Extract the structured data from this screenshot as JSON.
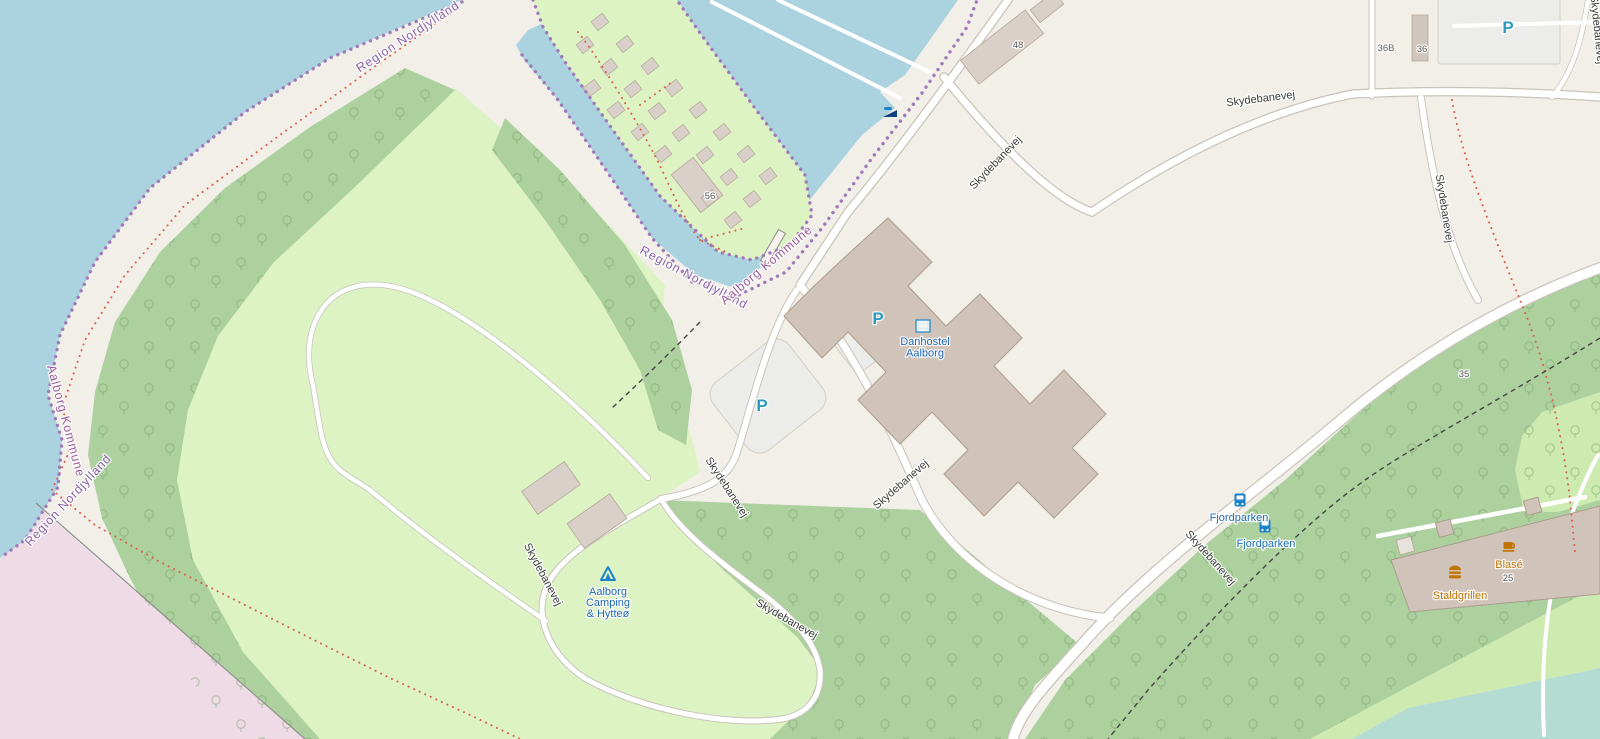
{
  "map": {
    "colors": {
      "land": "#f2efe9",
      "water": "#aad3df",
      "water_shallow": "#b5dcd2",
      "field": "#ddf3c4",
      "forest": "#add19e",
      "grass": "#cdebb0",
      "military_pink": "#eedbe6",
      "building": "#d9d0c9",
      "building_stroke": "#b3a796",
      "building_large": "#cfc3ba",
      "parking": "#ececea",
      "road_fill": "#ffffff",
      "road_casing": "#c9c3ba",
      "boundary": "#9f7bb8",
      "path_red": "#dd5f4a",
      "path_dashed": "#454545",
      "label_road": "#3d3d3d",
      "label_housenumber": "#5f5f5f",
      "label_boundary_region": "#8a63a8",
      "label_boundary_kommune": "#9d5b9d",
      "label_transport": "#2470b8",
      "label_tourism": "#2069b3",
      "label_amenity": "#c17404",
      "icon_blue": "#1d83c9",
      "icon_parking": "#2f9ac0",
      "icon_slipway": "#10427e"
    },
    "boundary_labels": [
      {
        "text": "Region Nordjylland",
        "x": 410,
        "y": 40,
        "rotate": -33,
        "kind": "region"
      },
      {
        "text": "Region Nordjylland",
        "x": 692,
        "y": 281,
        "rotate": 28,
        "kind": "region"
      },
      {
        "text": "Aalborg Kommune",
        "x": 769,
        "y": 268,
        "rotate": -40,
        "kind": "kommune"
      },
      {
        "text": "Aalborg Kommune",
        "x": 62,
        "y": 422,
        "rotate": 75,
        "kind": "kommune"
      },
      {
        "text": "Region Nordjylland",
        "x": 71,
        "y": 503,
        "rotate": -47,
        "kind": "region"
      }
    ],
    "road_labels": [
      {
        "text": "Skydebanevej",
        "x": 998,
        "y": 165,
        "rotate": -46
      },
      {
        "text": "Skydebanevej",
        "x": 1261,
        "y": 102,
        "rotate": -7
      },
      {
        "text": "Skydebanevej",
        "x": 1441,
        "y": 209,
        "rotate": 81
      },
      {
        "text": "Skydebanevej",
        "x": 1594,
        "y": 30,
        "rotate": 84
      },
      {
        "text": "Skydebanevej",
        "x": 903,
        "y": 487,
        "rotate": -41
      },
      {
        "text": "Skydebanevej",
        "x": 724,
        "y": 489,
        "rotate": 57
      },
      {
        "text": "Skydebanevej",
        "x": 540,
        "y": 576,
        "rotate": 62
      },
      {
        "text": "Skydebanevej",
        "x": 785,
        "y": 622,
        "rotate": 30
      },
      {
        "text": "Skydebanevej",
        "x": 1208,
        "y": 560,
        "rotate": 48
      }
    ],
    "house_numbers": [
      {
        "text": "56",
        "x": 710,
        "y": 199
      },
      {
        "text": "48",
        "x": 1018,
        "y": 48
      },
      {
        "text": "36B",
        "x": 1386,
        "y": 51
      },
      {
        "text": "36",
        "x": 1422,
        "y": 52
      },
      {
        "text": "35",
        "x": 1464,
        "y": 377
      },
      {
        "text": "25",
        "x": 1508,
        "y": 581
      }
    ],
    "pois": [
      {
        "name": "Danhostel Aalborg",
        "icon": "hostel-icon",
        "icon_x": 923,
        "icon_y": 326,
        "lines": [
          "Danhostel",
          "Aalborg"
        ],
        "label_x": 925,
        "label_y": 345,
        "line_height": 11.5,
        "color_key": "label_tourism"
      },
      {
        "name": "Aalborg Camping & Hytteø",
        "icon": "campsite-icon",
        "icon_x": 608,
        "icon_y": 574,
        "lines": [
          "Aalborg",
          "Camping",
          "& Hytteø"
        ],
        "label_x": 608,
        "label_y": 595,
        "line_height": 11,
        "color_key": "label_tourism"
      },
      {
        "name": "Fjordparken",
        "icon": "bus-icon",
        "icon_x": 1240,
        "icon_y": 500,
        "lines": [
          "Fjordparken"
        ],
        "label_x": 1239,
        "label_y": 521,
        "line_height": 11,
        "color_key": "label_transport"
      },
      {
        "name": "Fjordparken",
        "icon": "bus-icon",
        "icon_x": 1265,
        "icon_y": 526,
        "lines": [
          "Fjordparken"
        ],
        "label_x": 1266,
        "label_y": 547,
        "line_height": 11,
        "color_key": "label_transport"
      },
      {
        "name": "Staldgrillen",
        "icon": "fast-food-icon",
        "icon_x": 1455,
        "icon_y": 574,
        "lines": [
          "Staldgrillen"
        ],
        "label_x": 1460,
        "label_y": 599,
        "line_height": 11,
        "color_key": "label_amenity"
      },
      {
        "name": "Blasé",
        "icon": "cafe-icon",
        "icon_x": 1509,
        "icon_y": 546,
        "lines": [
          "Blasé"
        ],
        "label_x": 1509,
        "label_y": 568,
        "line_height": 11,
        "color_key": "label_amenity"
      }
    ],
    "parking_icons": [
      {
        "label": "P",
        "x": 878,
        "y": 318
      },
      {
        "label": "P",
        "x": 762,
        "y": 405
      },
      {
        "label": "P",
        "x": 1508,
        "y": 27
      }
    ],
    "slipway_icon": {
      "x": 890,
      "y": 112
    }
  }
}
